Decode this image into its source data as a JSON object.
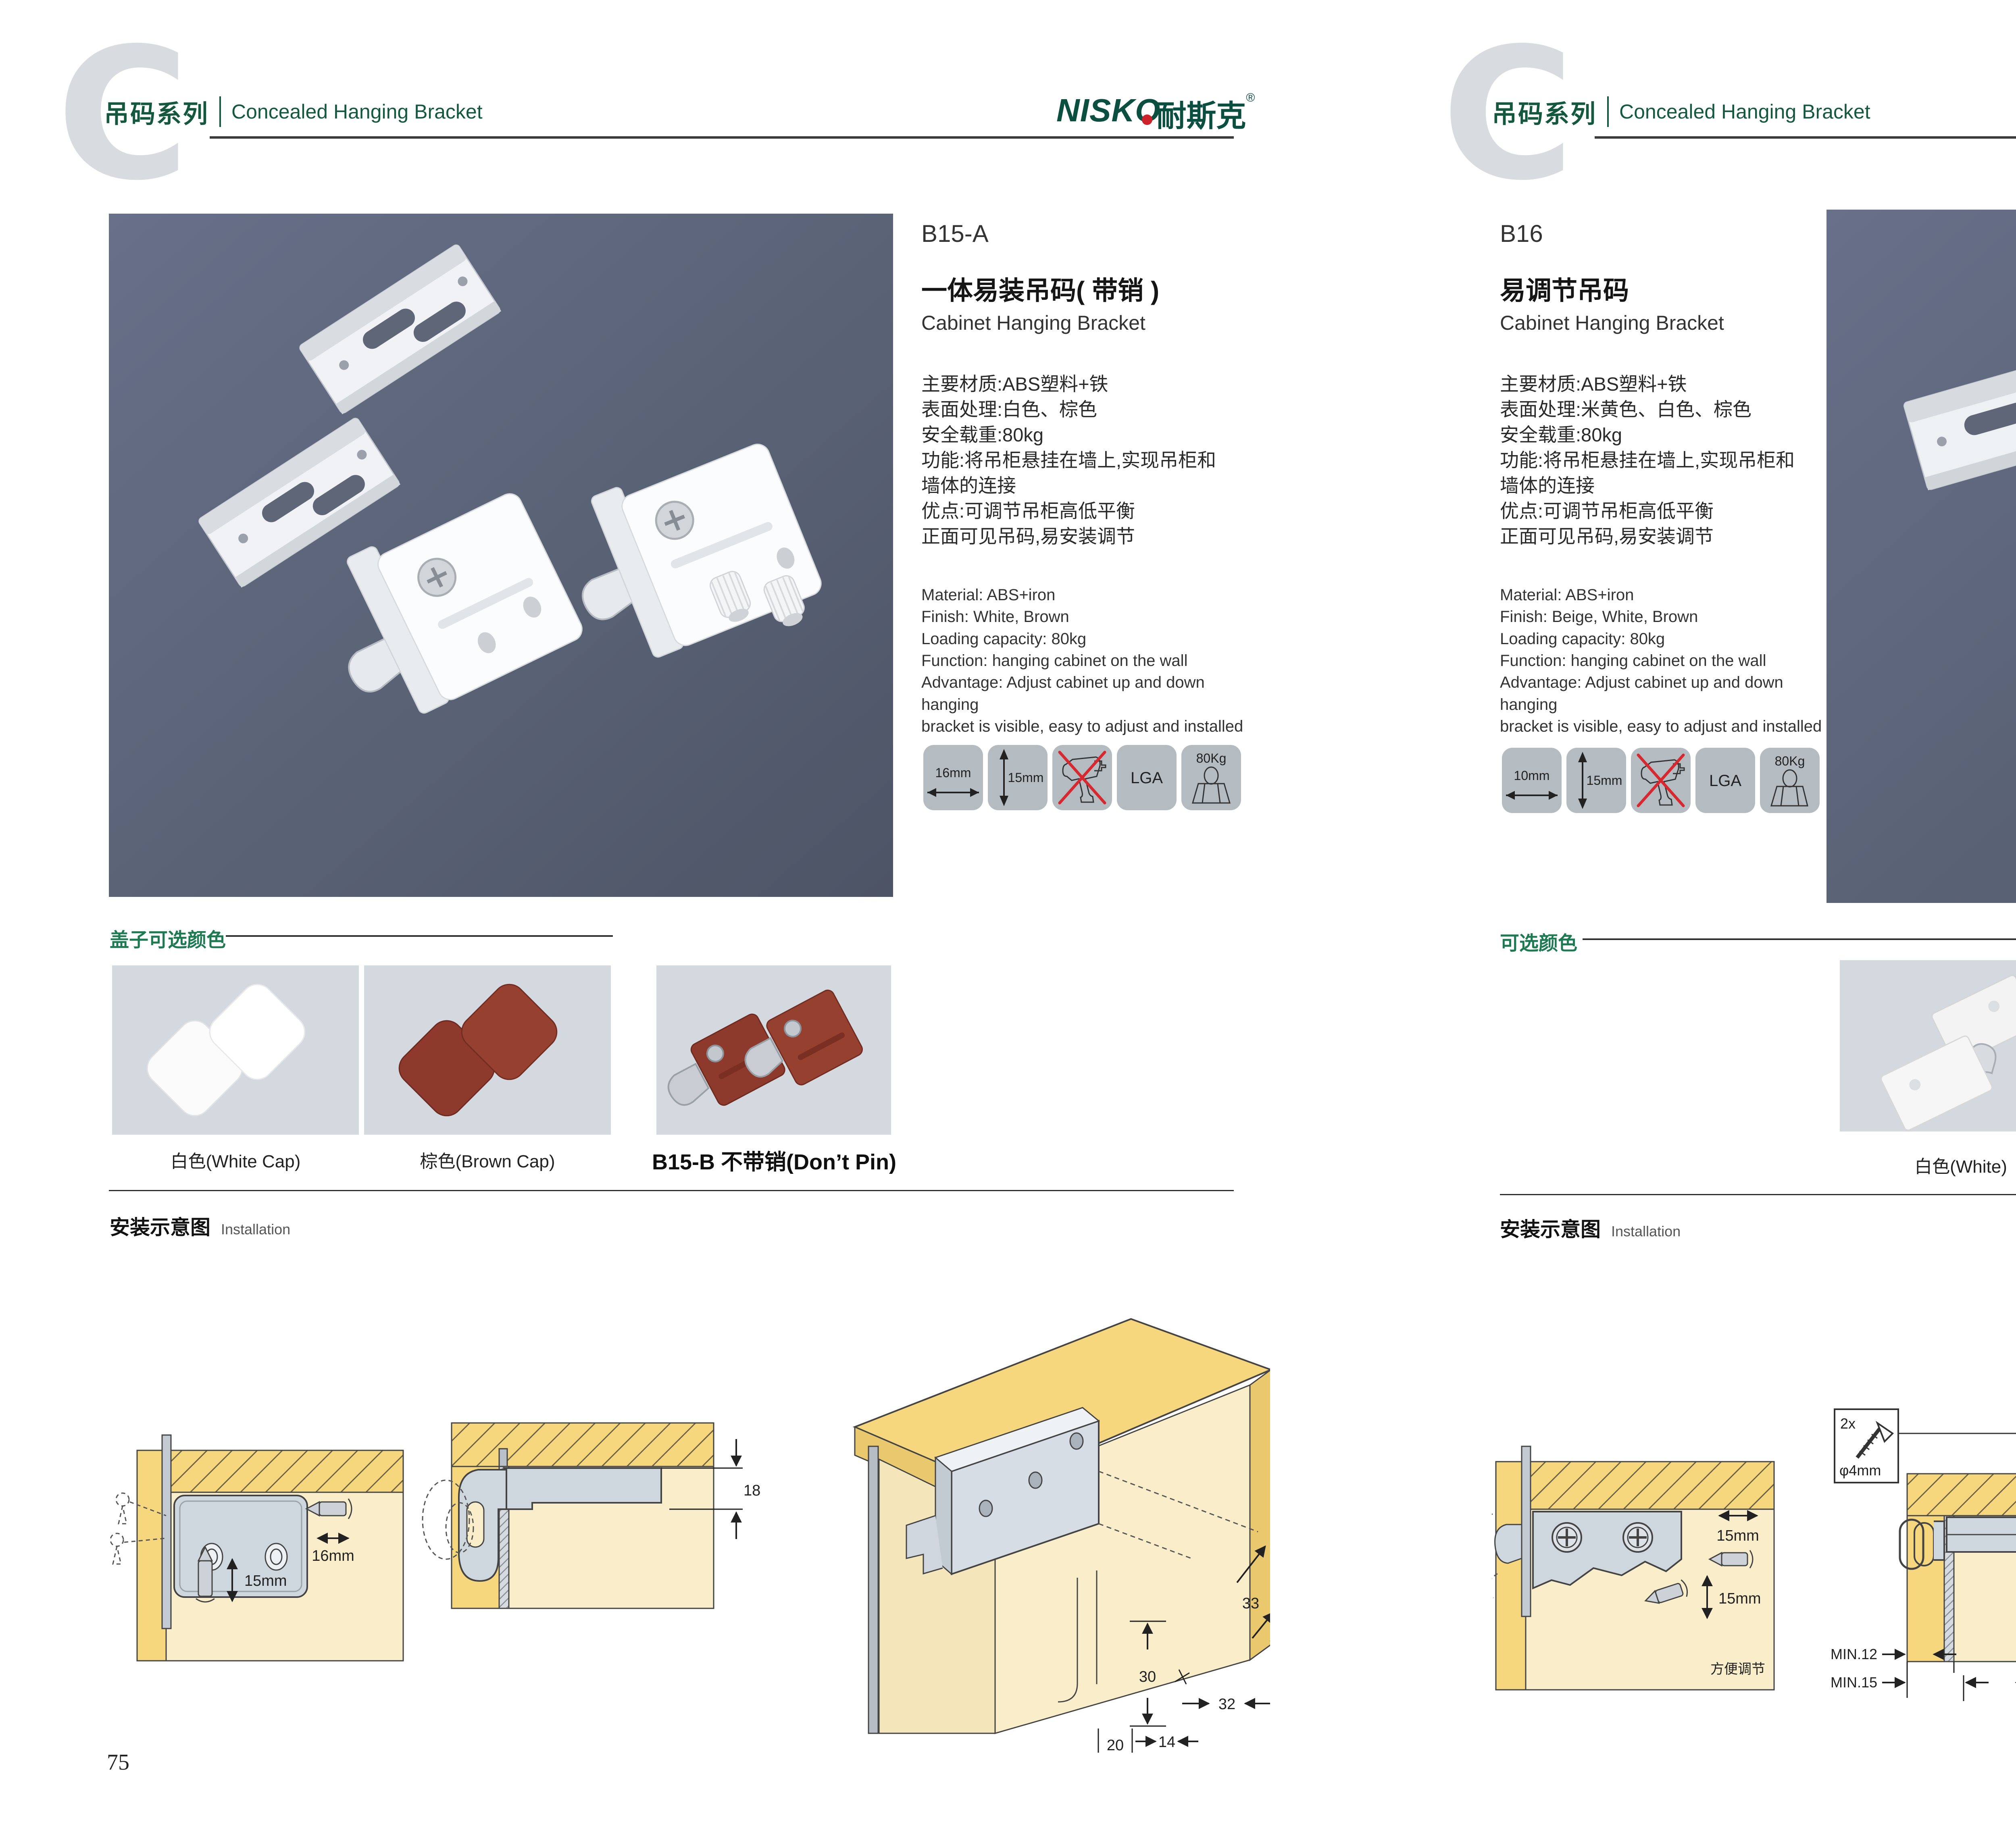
{
  "colors": {
    "accent_green": "#1e7a52",
    "logo_green": "#0b4f41",
    "logo_red": "#cc2229",
    "photo_background": "#5a6275",
    "tile_background": "#d3d9df",
    "icon_tile_background": "#b4bbc1",
    "wood_yellow": "#f6d77e",
    "cabinet_beige": "#f9edca",
    "bracket_gray": "#cfd7de",
    "warning_red": "#d7282f"
  },
  "header": {
    "watermark": "C",
    "series_cn": "吊码系列",
    "series_en": "Concealed Hanging Bracket",
    "logo_en": "NISKO",
    "logo_cn": "耐斯克",
    "logo_reg": "®"
  },
  "page_left": {
    "number": "75",
    "product": {
      "code": "B15-A",
      "name_cn": "一体易装吊码( 带销 )",
      "name_en": "Cabinet Hanging Bracket",
      "specs_cn": [
        "主要材质:ABS塑料+铁",
        "表面处理:白色、棕色",
        "安全载重:80kg",
        "功能:将吊柜悬挂在墙上,实现吊柜和",
        "墙体的连接",
        "优点:可调节吊柜高低平衡",
        "正面可见吊码,易安装调节"
      ],
      "specs_en": [
        "Material: ABS+iron",
        "Finish: White, Brown",
        "Loading capacity: 80kg",
        "Function: hanging cabinet on the wall",
        "Advantage: Adjust cabinet up and down hanging",
        "bracket is visible, easy to adjust and installed"
      ]
    },
    "spec_icons": [
      {
        "name": "width-arrow",
        "label": "16mm"
      },
      {
        "name": "height-arrow",
        "label": "15mm"
      },
      {
        "name": "no-drill",
        "label": ""
      },
      {
        "name": "lga-cert",
        "label": "LGA"
      },
      {
        "name": "load-capacity",
        "label": "80Kg"
      }
    ],
    "color_section": {
      "title": "盖子可选颜色",
      "options": [
        {
          "label": "白色(White Cap)"
        },
        {
          "label": "棕色(Brown Cap)"
        },
        {
          "label": "B15-B 不带销(Don’t Pin)"
        }
      ]
    },
    "installation": {
      "title_cn": "安装示意图",
      "title_en": "Installation",
      "d1": {
        "h": "16mm",
        "v": "15mm"
      },
      "d2": {
        "gap": "18"
      },
      "d3": {
        "a": "33",
        "b": "30",
        "c": "32",
        "d": "20",
        "e": "14"
      }
    }
  },
  "page_right": {
    "number": "76",
    "product": {
      "code": "B16",
      "name_cn": "易调节吊码",
      "name_en": "Cabinet Hanging Bracket",
      "specs_cn": [
        "主要材质:ABS塑料+铁",
        "表面处理:米黄色、白色、棕色",
        "安全载重:80kg",
        "功能:将吊柜悬挂在墙上,实现吊柜和",
        "墙体的连接",
        "优点:可调节吊柜高低平衡",
        "正面可见吊码,易安装调节"
      ],
      "specs_en": [
        "Material: ABS+iron",
        "Finish: Beige, White, Brown",
        "Loading capacity: 80kg",
        "Function: hanging cabinet on the wall",
        "Advantage: Adjust cabinet up and down hanging",
        "bracket is visible, easy to adjust and installed"
      ]
    },
    "spec_icons": [
      {
        "name": "width-arrow",
        "label": "10mm"
      },
      {
        "name": "height-arrow",
        "label": "15mm"
      },
      {
        "name": "no-drill",
        "label": ""
      },
      {
        "name": "lga-cert",
        "label": "LGA"
      },
      {
        "name": "load-capacity",
        "label": "80Kg"
      }
    ],
    "color_section": {
      "title": "可选颜色",
      "options": [
        {
          "label": "白色(White)"
        },
        {
          "label": "棕色(Brown )"
        },
        {
          "label": "米黄色 (Beige)"
        }
      ]
    },
    "installation": {
      "title_cn": "安装示意图",
      "title_en": "Installation",
      "d1": {
        "h": "15mm",
        "v": "15mm",
        "note": "方便调节"
      },
      "screw_box": {
        "count": "2x",
        "dia": "φ4mm"
      },
      "d2": {
        "gap": "19",
        "min1": "MIN.12",
        "min2": "MIN.15"
      },
      "d3": {
        "a": "30",
        "b": "32",
        "c": "RMAX4",
        "d": "19",
        "e": "20",
        "f": "32"
      }
    }
  }
}
